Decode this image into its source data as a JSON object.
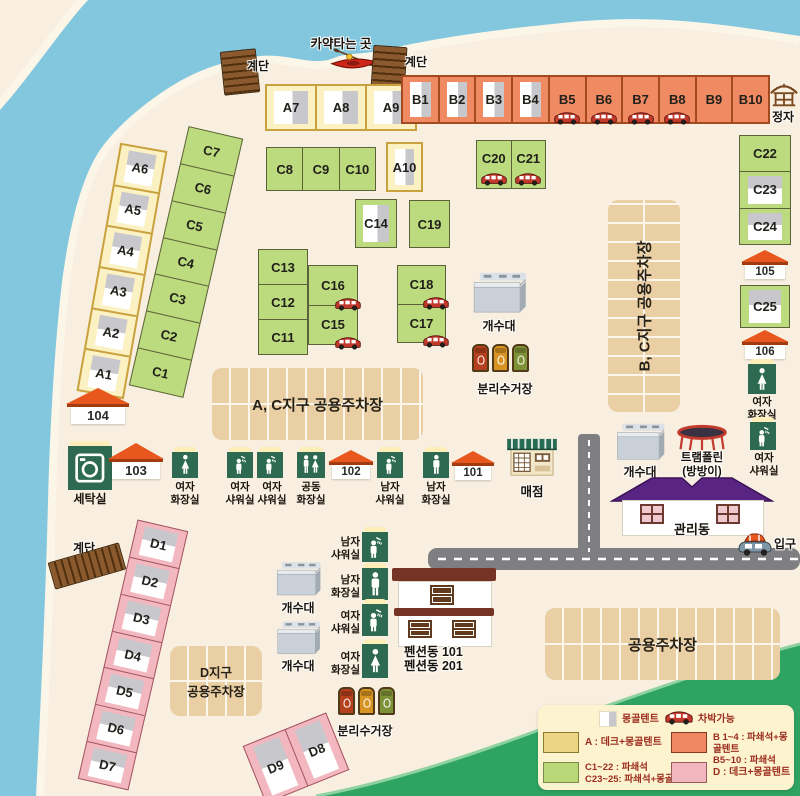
{
  "top": {
    "kayak_label": "카약타는 곳",
    "stairs_label": "계단",
    "pavilion_label": "정자"
  },
  "areas": {
    "a_top": [
      "A7",
      "A8",
      "A9"
    ],
    "b_row": [
      "B1",
      "B2",
      "B3",
      "B4",
      "B5",
      "B6",
      "B7",
      "B8",
      "B9",
      "B10"
    ],
    "a_col": [
      "A6",
      "A5",
      "A4",
      "A3",
      "A2",
      "A1"
    ],
    "c_col": [
      "C7",
      "C6",
      "C5",
      "C4",
      "C3",
      "C2",
      "C1"
    ],
    "c_row1": [
      "C8",
      "C9",
      "C10"
    ],
    "a10": "A10",
    "c_row2": [
      "C20",
      "C21"
    ],
    "c14": "C14",
    "c19": "C19",
    "c_stack1": [
      "C13",
      "C12",
      "C11"
    ],
    "c_stack2": [
      "C16",
      "C15"
    ],
    "c_stack3": [
      "C18",
      "C17"
    ],
    "c_right": [
      "C22",
      "C23",
      "C24"
    ],
    "c25": "C25",
    "d_col": [
      "D1",
      "D2",
      "D3",
      "D4",
      "D5",
      "D6",
      "D7"
    ],
    "d_pair": [
      "D9",
      "D8"
    ]
  },
  "markers": {
    "m101": "101",
    "m102": "102",
    "m103": "103",
    "m104": "104",
    "m105": "105",
    "m106": "106"
  },
  "parking": {
    "bc": "B, C지구 공용주차장",
    "ac": "A, C지구 공용주차장",
    "d": "D지구\n공용주차장",
    "common": "공용주차장"
  },
  "facilities": {
    "laundry": "세탁실",
    "women_toilet": "여자\n화장실",
    "women_shower": "여자\n샤워실",
    "common_toilet": "공동\n화장실",
    "men_shower": "남자\n샤워실",
    "men_toilet": "남자\n화장실",
    "store": "매점",
    "sink": "개수대",
    "trampoline": "트램폴린\n(방방이)",
    "mgmt": "관리동",
    "entrance": "입구",
    "recycle": "분리수거장",
    "pension": "펜션동 101\n펜션동 201"
  },
  "legend": {
    "tent": "몽골텐트",
    "car": "차박가능",
    "a": "A : 데크+몽골텐트",
    "b": "B 1~4 : 파쇄석+몽골텐트\nB5~10 : 파쇄석",
    "c": "C1~22 : 파쇄석\nC23~25: 파쇄석+몽골텐트",
    "d": "D : 데크+몽골텐트"
  },
  "icons": {
    "tent-icon": "white+gray two-tone rectangle",
    "car-icon": "red van (car camping)",
    "stairs-icon": "brown wooden steps",
    "kayak-icon": "red kayak with paddle",
    "pavilion-icon": "brown pavilion outline",
    "woman-icon": "white woman pictogram on green",
    "man-icon": "white man pictogram on green",
    "shower-icon": "white shower pictogram on green",
    "dual-icon": "man+woman pictogram on green",
    "washer-icon": "washing machine pictogram on green",
    "sink-icon": "gray dishwashing station",
    "store-icon": "kiosk with green awning",
    "trampoline-icon": "red-rim trampoline",
    "recycle-bins-icon": "three colored bins",
    "roof-icon": "orange roof number marker",
    "entrance-car-icon": "car with orange roof tent"
  },
  "colors": {
    "sand": "#f8efe0",
    "water": "#82c7dd",
    "beach": "#fcf6e8",
    "hill": "#2fa361",
    "road": "#7f7f82",
    "lot": "#e9cfa3",
    "site_a_yellow": "#fbf1c3",
    "site_b_orange": "#f08a62",
    "site_c_green": "#bcda7e",
    "site_d_pink": "#f3b7c0",
    "marker_roof": "#e8581e",
    "facility_green": "#2e6a51",
    "mgmt_roof_purple": "#5a2482",
    "pension_roof_brown": "#753326",
    "legend_bg": "#fdf4cf",
    "legend_text": "#9b2d1f"
  }
}
